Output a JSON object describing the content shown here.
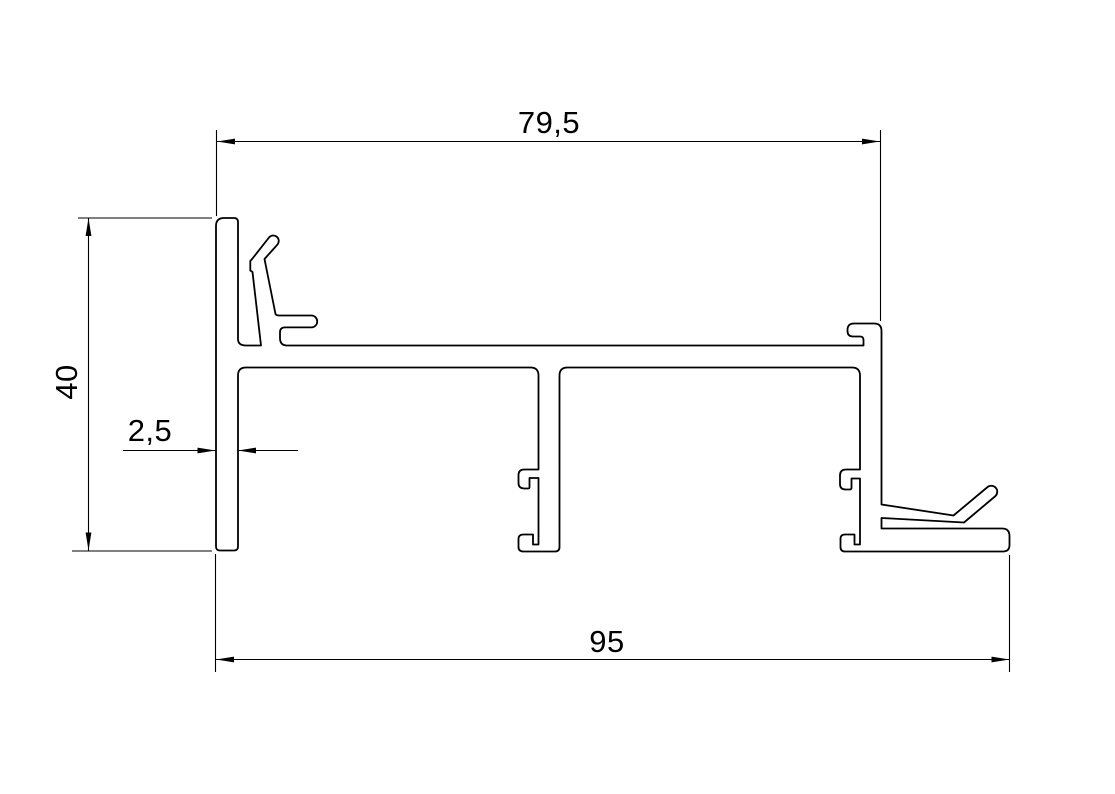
{
  "drawing": {
    "background_color": "#ffffff",
    "line_color": "#000000",
    "text_color": "#000000",
    "dimensions": {
      "top_width": {
        "label": "79,5"
      },
      "left_height": {
        "label": "40"
      },
      "wall_thickness": {
        "label": "2,5"
      },
      "bottom_width": {
        "label": "95"
      }
    }
  }
}
